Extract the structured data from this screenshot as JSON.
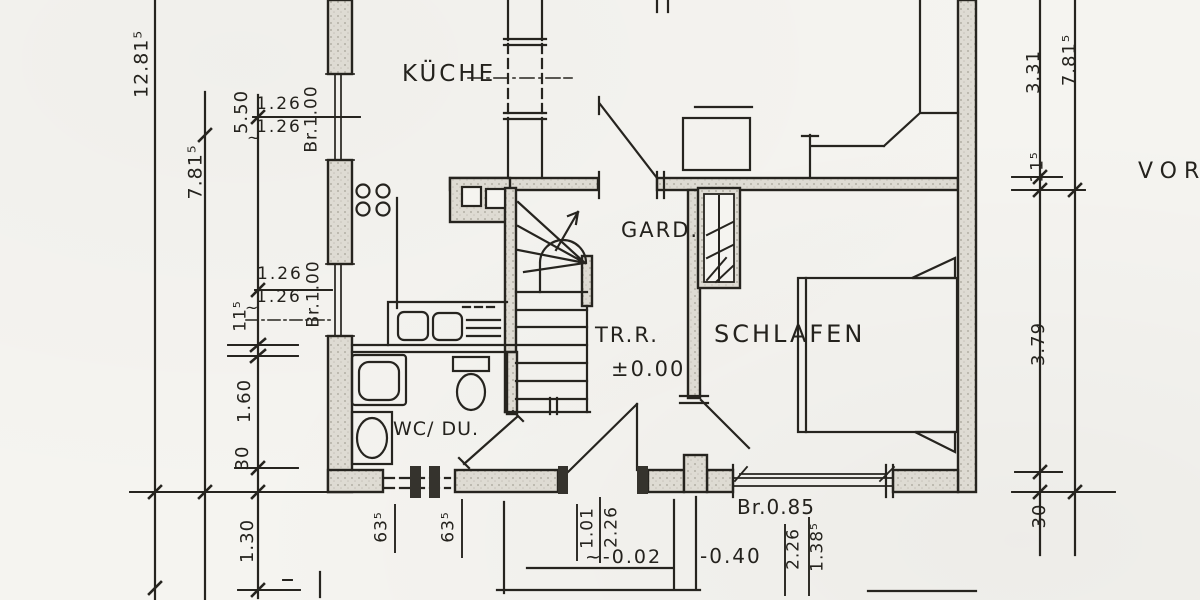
{
  "rooms": {
    "kitchen": "KÜCHE",
    "wardrobe": "GARD.",
    "stairs": "TR.R.",
    "stairs_level": "±0.00",
    "bedroom": "SCHLAFEN",
    "bath": "WC/ DU.",
    "right_partial_word": "VOR"
  },
  "dims": {
    "left": {
      "total": "12.81⁵",
      "inner": "7.81⁵",
      "kitchen": "5.50",
      "w1a": "1.26",
      "w1b": "1.26",
      "w1br": "Br.1.00",
      "w1t": "~",
      "w2a": "1.26",
      "w2b": "1.26",
      "w2br": "Br.1.00",
      "w2t": "~",
      "wall": "11⁵",
      "s160": "1.60",
      "s30": "30",
      "s130": "1.30"
    },
    "bottom": {
      "p1": "63⁵",
      "p2": "63⁵",
      "entry_w": "1.01",
      "entry_h": "2.26",
      "lvl_in": "~-0.02",
      "lvl_out": "-0.40",
      "door": "Br.0.85",
      "win_h": "2.26",
      "win_s": "1.38⁵"
    },
    "right": {
      "s331": "3.31",
      "total": "7.81⁵",
      "wall": "11⁵",
      "s379": "3.79",
      "s30": "30"
    }
  }
}
